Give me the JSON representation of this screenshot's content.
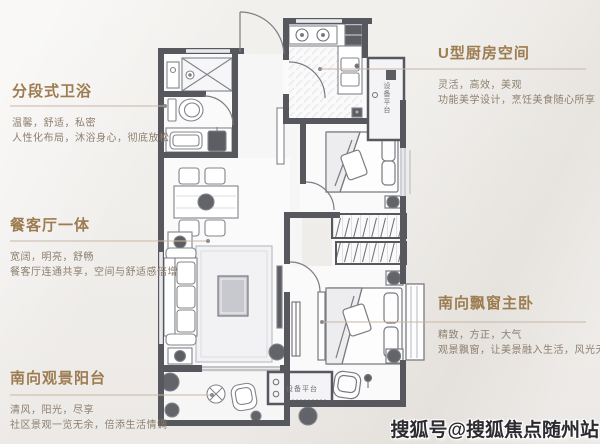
{
  "annotations": {
    "bathroom": {
      "title": "分段式卫浴",
      "line1": "温馨，舒适，私密",
      "line2": "人性化布局，沐浴身心，彻底放松"
    },
    "kitchen": {
      "title": "U型厨房空间",
      "line1": "灵活，高效，美观",
      "line2": "功能美学设计，烹饪美食随心所享"
    },
    "living_dining": {
      "title": "餐客厅一体",
      "line1": "宽阔，明亮，舒畅",
      "line2": "餐客厅连通共享，空间与舒适感倍增"
    },
    "balcony": {
      "title": "南向观景阳台",
      "line1": "清风，阳光，尽享",
      "line2": "社区景观一览无余，倍添生活情调"
    },
    "master_bedroom": {
      "title": "南向飘窗主卧",
      "line1": "精致，方正，大气",
      "line2": "观景飘窗，让美景融入生活，风光无限"
    }
  },
  "floorplan": {
    "equipment_platform_top": "设备平台",
    "equipment_platform_bottom": "设备平台"
  },
  "watermark": {
    "text": "搜狐号@搜狐焦点随州站"
  },
  "colors": {
    "title_text": "#9c7c50",
    "body_text": "#8d7e6e",
    "leader_line": "#c9b6a6",
    "wall": "#57585d",
    "watermark_text": "#2c2c30",
    "page_bg": "#f1efec"
  }
}
